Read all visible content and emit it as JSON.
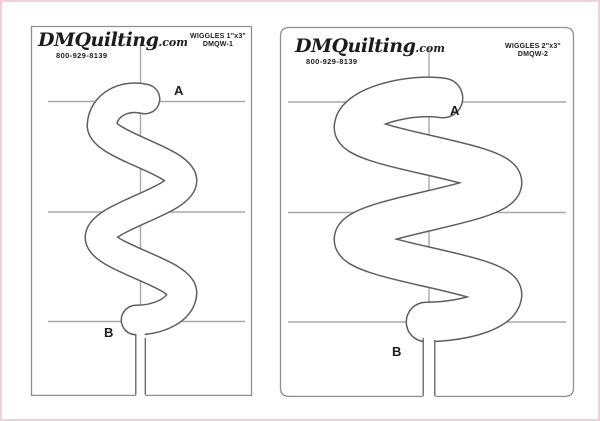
{
  "frame": {
    "accent_pink": "#f2cfdd",
    "background": "#ffffff"
  },
  "colors": {
    "template_outline": "#5f5f5f",
    "panel_border": "#8f8f8f",
    "guide_line": "#a8a8a8",
    "text": "#1c1c1c"
  },
  "panels": [
    {
      "brand_script": "DMQuilting",
      "brand_suffix": ".com",
      "phone": "800-929-8139",
      "product": "WIGGLES 1\"x3\"",
      "model": "DMQW-1",
      "point_a": "A",
      "point_b": "B"
    },
    {
      "brand_script": "DMQuilting",
      "brand_suffix": ".com",
      "phone": "800-929-8139",
      "product": "WIGGLES 2\"x3\"",
      "model": "DMQW-2",
      "point_a": "A",
      "point_b": "B"
    }
  ]
}
